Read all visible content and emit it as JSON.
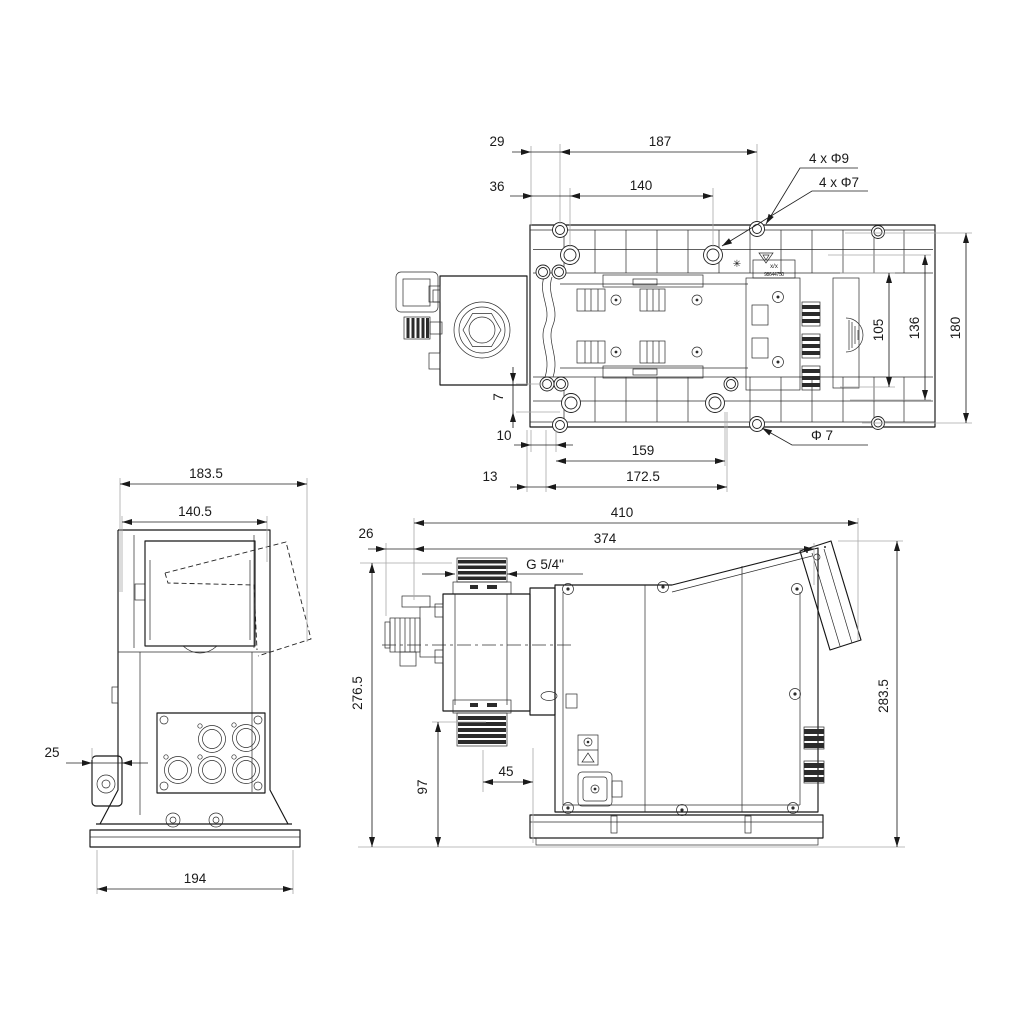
{
  "drawing": {
    "kind": "dosing pump dimensional drawing, three orthographic views",
    "views": {
      "top": {
        "name": "top view (back plate)",
        "dims": {
          "width_29": "29",
          "width_187": "187",
          "width_36": "36",
          "width_140": "140",
          "holes_phi9": "4 x Φ9",
          "holes_phi7": "4 x Φ7",
          "height_105": "105",
          "height_136": "136",
          "height_180": "180",
          "offset_7": "7",
          "offset_10": "10",
          "width_159": "159",
          "hole_phi7": "Φ 7",
          "offset_13": "13",
          "width_172_5": "172.5"
        },
        "sticker": {
          "line1": "x/x",
          "line2": "98644750"
        }
      },
      "side": {
        "name": "left side view",
        "dims": {
          "depth_183_5": "183.5",
          "depth_140_5": "140.5",
          "offset_25": "25",
          "base_194": "194"
        }
      },
      "front": {
        "name": "front view",
        "dims": {
          "width_410": "410",
          "width_374": "374",
          "offset_26": "26",
          "thread": "G 5/4\"",
          "height_276_5": "276.5",
          "height_283_5": "283.5",
          "height_97": "97",
          "offset_45": "45"
        }
      }
    },
    "colors": {
      "line": "#1a1a1a",
      "extension": "#a9a9a9",
      "background": "#ffffff"
    }
  }
}
